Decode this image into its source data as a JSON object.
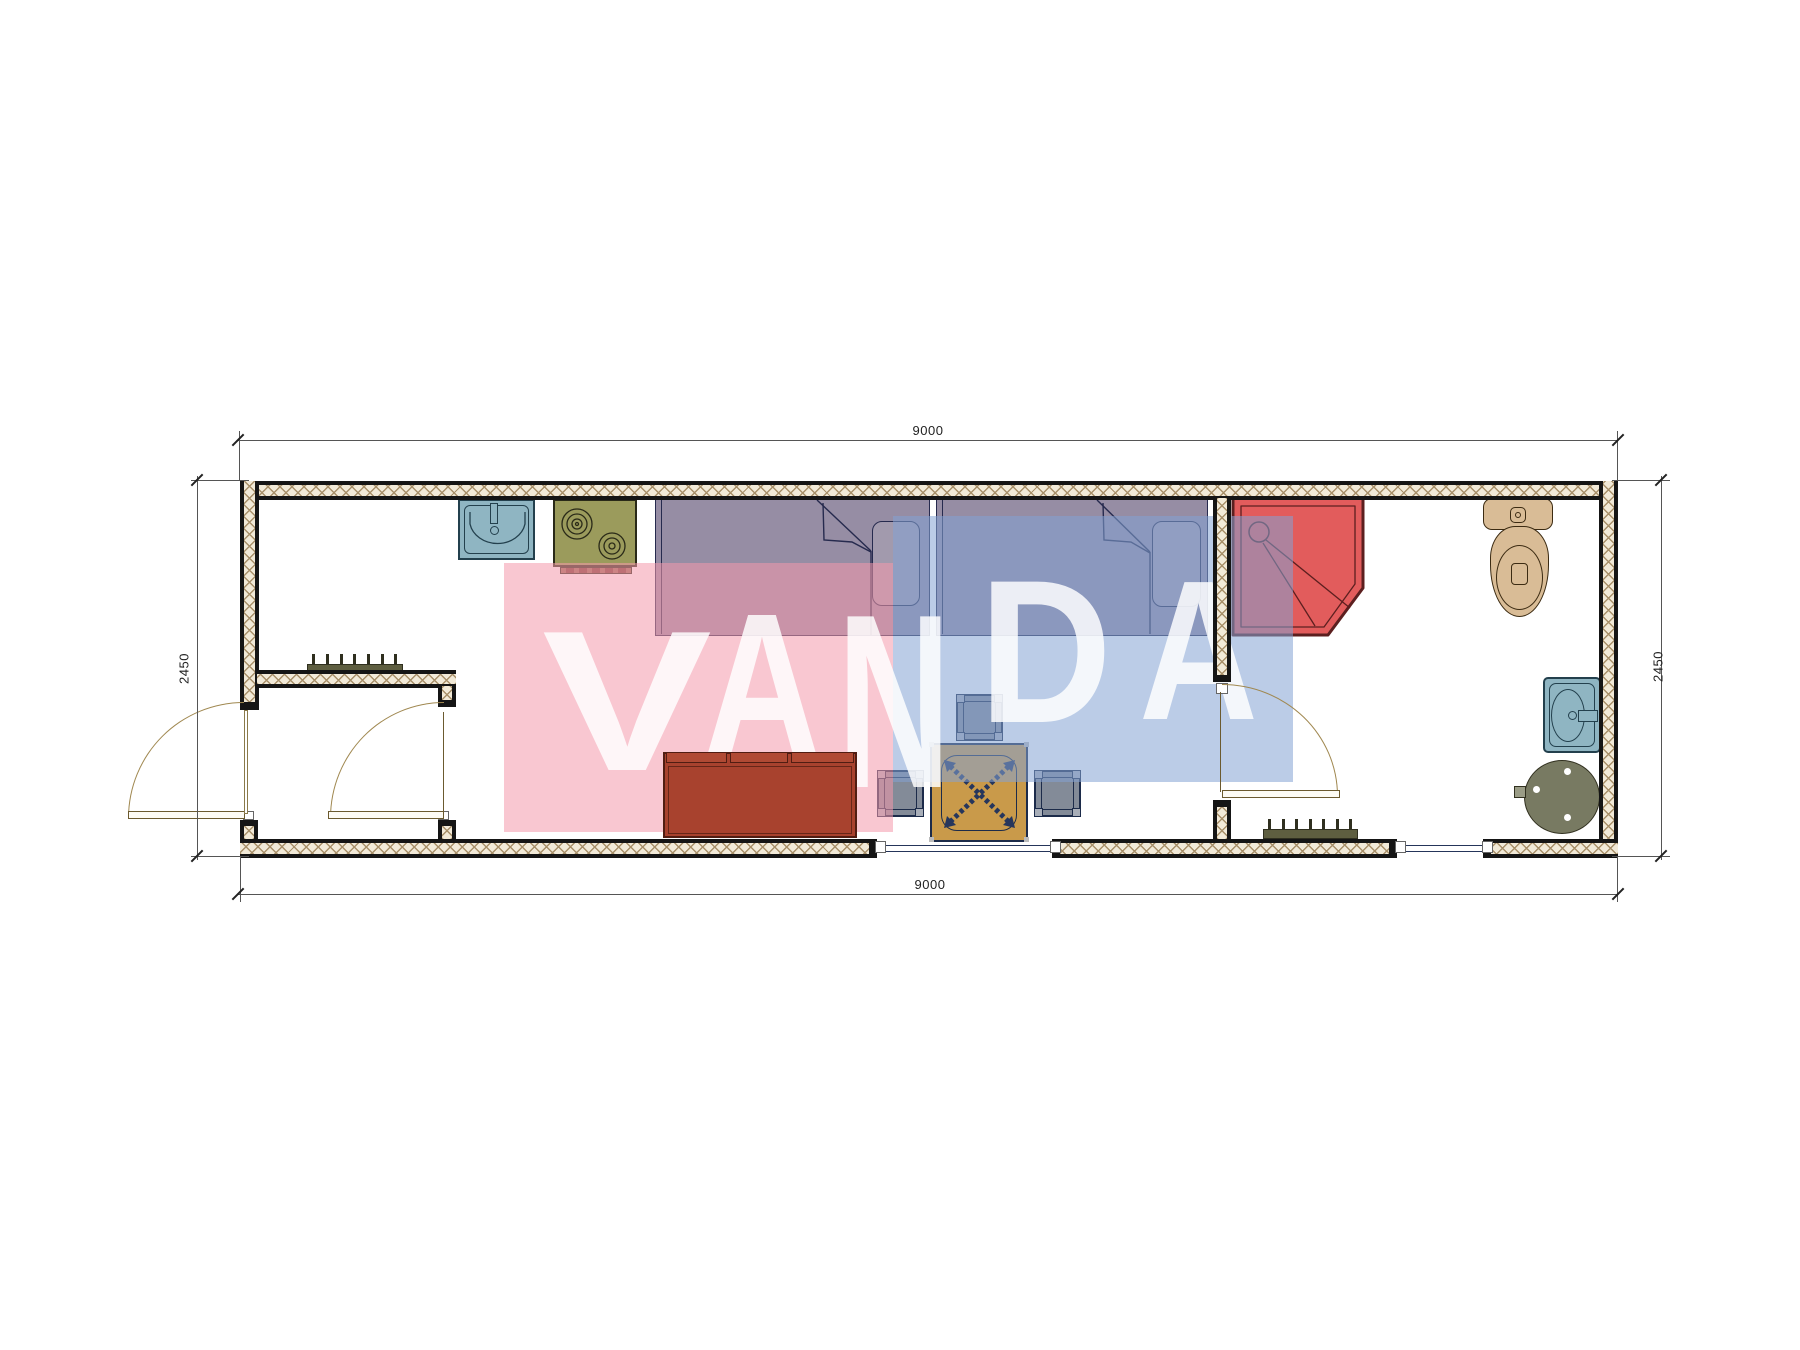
{
  "drawing": {
    "type": "floor-plan",
    "unit_note": "dimension labels as printed on drawing"
  },
  "dimensions": {
    "top": "9000",
    "bottom": "9000",
    "left": "2450",
    "right": "2450"
  },
  "watermark": {
    "word": "VANDA",
    "l1": "V",
    "l2": "A",
    "l3": "N",
    "l4": "D",
    "l5": "A",
    "pink": "#F499AC",
    "blue": "#84A2D4",
    "letter_color": "#FFFFFF"
  },
  "colors": {
    "wall_fill": "#F2EAD8",
    "wall_hatch": "#A8906A",
    "wall_edge": "#151515",
    "bed": "#968DA4",
    "shower": "#E25C5C",
    "sofa": "#A8422E",
    "table": "#C99A4A",
    "chair": "#838B98",
    "sink": "#8FB5C2",
    "stove": "#9B9B5C",
    "toilet": "#D9BC96",
    "water_heater": "#787A62",
    "radiator": "#5E5E40",
    "door_arc": "#A08850",
    "window_line": "#25355A",
    "dimension_text": "#222222"
  }
}
